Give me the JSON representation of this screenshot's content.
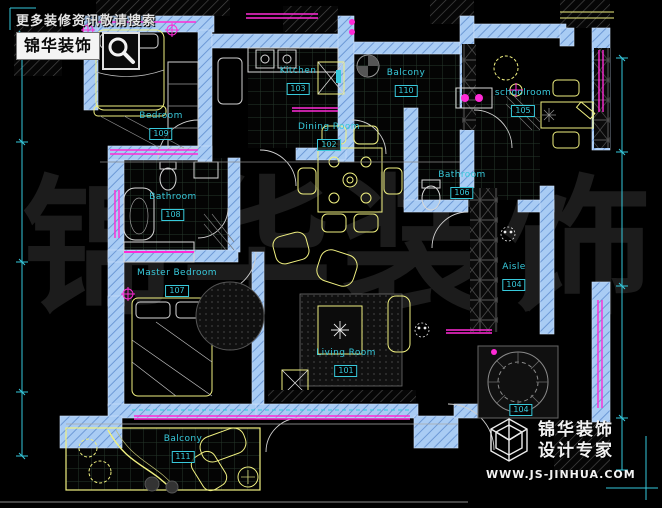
{
  "watermark": {
    "text": "锦华装饰"
  },
  "promo": {
    "search_hint": "更多装修资讯敬请搜索",
    "brand_badge": "锦华装饰"
  },
  "logo": {
    "brand": "锦华装饰",
    "tagline": "设计专家",
    "website": "WWW.JS-JINHUA.COM"
  },
  "rooms": [
    {
      "name": "Bedroom",
      "number": "109"
    },
    {
      "name": "Kitchen",
      "number": "103"
    },
    {
      "name": "Balcony",
      "number": "110"
    },
    {
      "name": "schoolroom",
      "number": "105"
    },
    {
      "name": "Dining Room",
      "number": "102"
    },
    {
      "name": "Bathroom",
      "number": "106"
    },
    {
      "name": "Bathroom",
      "number": "108"
    },
    {
      "name": "Master Bedroom",
      "number": "107"
    },
    {
      "name": "Aisle",
      "number": "104"
    },
    {
      "name": "Living Room",
      "number": "101"
    },
    {
      "name": "Balcony",
      "number": "111"
    },
    {
      "name": "",
      "number": "104"
    }
  ],
  "colors": {
    "wall_blue": "#a9ccf4",
    "furniture_yellow": "#f0f080",
    "window_magenta": "#ff2bd6",
    "label_cyan": "#38c9db",
    "watermark_gray": "#1c1c1c"
  }
}
